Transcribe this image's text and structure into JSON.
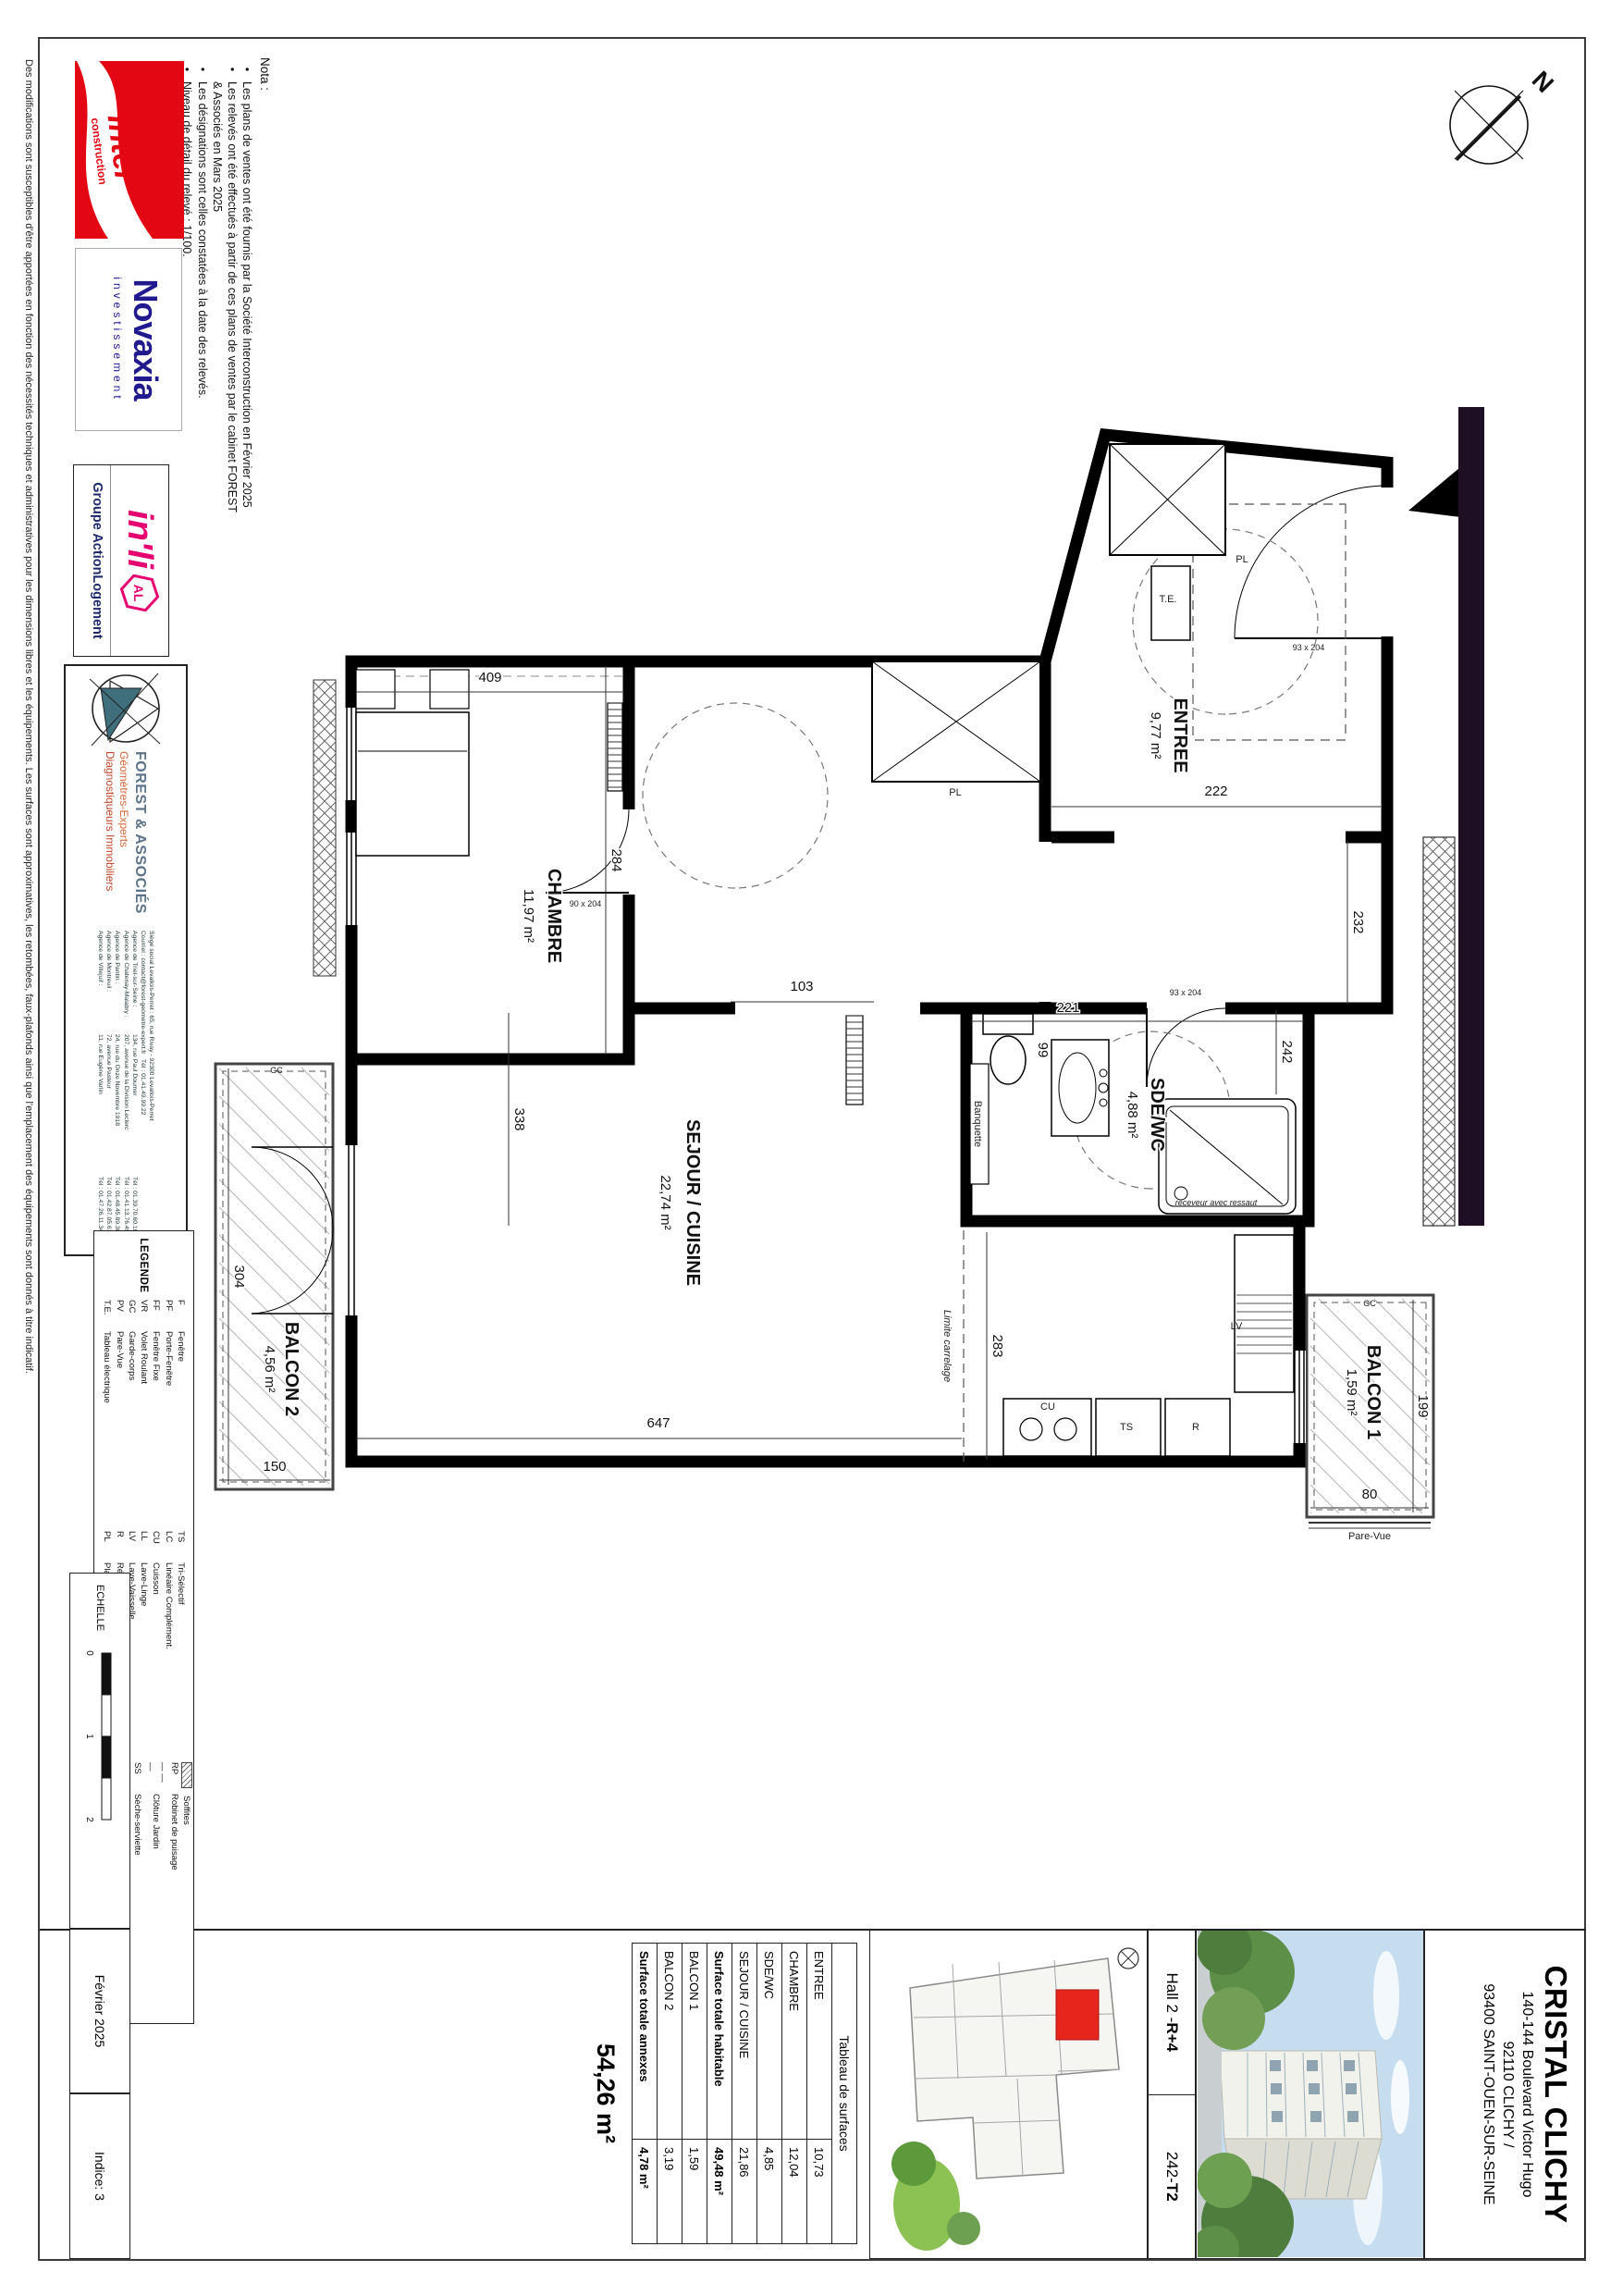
{
  "page": {
    "disclaimer": "Des modifications sont susceptibles d'être apportées en fonction des nécessités techniques et administratives pour les dimensions libres et les équipements. Les surfaces sont approximatives, les retombées, faux-plafonds ainsi que l'emplacement des équipements sont donnés à titre indicatif."
  },
  "nota": {
    "title": "Nota :",
    "lines": [
      {
        "bullet": "•",
        "text": "Les plans de ventes ont été fournis par la Société Interconstruction en Février 2025"
      },
      {
        "bullet": "•",
        "text": "Les relevés ont été effectués à partir de ces plans de ventes par le cabinet FOREST"
      },
      {
        "bullet": "",
        "text": "& Associés en Mars 2025"
      },
      {
        "bullet": "•",
        "text": "Les désignations sont celles constatées à la date des relevés."
      },
      {
        "bullet": "•",
        "text": "Niveau de détail du relevé : 1/100."
      }
    ]
  },
  "logos": {
    "inter_line1": "Inter",
    "inter_line2": "construction",
    "novaxia": "Novaxia",
    "novaxia_sub": "investissement",
    "inli": "in'li",
    "inli_badge": "AL",
    "inli_sub": "Groupe ActionLogement"
  },
  "forest": {
    "name": "FOREST & ASSOCIÉS",
    "sub1": "Géomètres-Experts",
    "sub2": "Diagnostiqueurs Immobiliers",
    "siege1": "Siège social Levallois-Perret : 65, rue Rivay - 92300 Levallois-Perret",
    "siege2": "Courriel : contact@forest-geometre-expert.fr",
    "siege3": "Tél : 01.41.49.99.22",
    "agences": [
      {
        "n": "Agence de Triel-sur-Seine :",
        "a": "134, rue Paul Doumer",
        "t": "Tél : 01.39.70.60.10"
      },
      {
        "n": "Agence de Chatenay-Malabry :",
        "a": "207, avenue de la Division Leclerc",
        "t": "Tél : 01.41.13.76.49"
      },
      {
        "n": "Agence de Pantin :",
        "a": "24, rue du Onze Novembre 1918",
        "t": "Tél : 01.48.45.89.30"
      },
      {
        "n": "Agence de Montreuil :",
        "a": "72, avenue Pasteur",
        "t": "Tél : 01.42.87.05.61"
      },
      {
        "n": "Agence de Villejuif :",
        "a": "11, rue Eugène Varlin",
        "t": "Tél : 01.47.26.11.34"
      }
    ]
  },
  "legend": {
    "title": "LEGENDE",
    "col1": [
      {
        "k": "F",
        "v": "Fenêtre"
      },
      {
        "k": "PF",
        "v": "Porte-Fenêtre"
      },
      {
        "k": "FF",
        "v": "Fenêtre Fixe"
      },
      {
        "k": "VR",
        "v": "Volet Roulant"
      },
      {
        "k": "GC",
        "v": "Garde-corps"
      },
      {
        "k": "PV",
        "v": "Pare-Vue"
      },
      {
        "k": "T.E.",
        "v": "Tableau électrique"
      }
    ],
    "col2": [
      {
        "k": "TS",
        "v": "Tri-Sélectif"
      },
      {
        "k": "LC",
        "v": "Linéaire Complément."
      },
      {
        "k": "CU",
        "v": "Cuisson"
      },
      {
        "k": "LL",
        "v": "Lave-Linge"
      },
      {
        "k": "LV",
        "v": "Lave-Vaisselle"
      },
      {
        "k": "R",
        "v": "Réfrigérateur"
      },
      {
        "k": "PL",
        "v": "Placard"
      }
    ],
    "col3": [
      {
        "k": "",
        "v": "Soffites"
      },
      {
        "k": "RP",
        "v": "Robinet de puisage"
      },
      {
        "k": "— — —",
        "v": "Clôture Jardin"
      },
      {
        "k": "SS",
        "v": "Sèche-serviette"
      },
      {
        "k": "TV",
        "v": "Trappe de visite"
      },
      {
        "k": "",
        "v": "Radiateur"
      },
      {
        "k": "HSS",
        "v": "Hauteur sous soffite"
      }
    ]
  },
  "surfaces_table": {
    "title": "Tableau de surfaces",
    "rows": [
      {
        "label": "ENTREE",
        "value": "10,73"
      },
      {
        "label": "CHAMBRE",
        "value": "12,04"
      },
      {
        "label": "SDE/WC",
        "value": "4,85"
      },
      {
        "label": "SEJOUR / CUISINE",
        "value": "21,86"
      }
    ],
    "total_habitable_label": "Surface totale habitable",
    "total_habitable_value": "49,48 m²",
    "annex_rows": [
      {
        "label": "BALCON 1",
        "value": "1,59"
      },
      {
        "label": "BALCON 2",
        "value": "3,19"
      }
    ],
    "total_annexes_label": "Surface totale annexes",
    "total_annexes_value": "4,78 m²",
    "grand_total": "54,26 m²"
  },
  "title_block": {
    "project": "CRISTAL CLICHY",
    "address1": "140-144 Boulevard Victor Hugo",
    "address2": "92110 CLICHY /",
    "address3": "93400 SAINT-OUEN-SUR-SEINE",
    "hall_prefix": "Hall 2 - ",
    "hall_bold": "R+4",
    "lot_prefix": "242-",
    "lot_bold": "T2"
  },
  "footer": {
    "echelle": "ECHELLE",
    "tick0": "0",
    "tick1": "1",
    "tick2": "2",
    "date": "Février 2025",
    "indice": "Indice: 3"
  },
  "plan": {
    "north": "N",
    "rooms": {
      "entree": {
        "name": "ENTREE",
        "area": "9,77 m²"
      },
      "chambre": {
        "name": "CHAMBRE",
        "area": "11,97 m²"
      },
      "sde": {
        "name": "SDE/WC",
        "area": "4,88 m²"
      },
      "sejour": {
        "name": "SEJOUR / CUISINE",
        "area": "22,74 m²"
      },
      "balcon1": {
        "name": "BALCON 1",
        "area": "1,59 m²"
      },
      "balcon2": {
        "name": "BALCON 2",
        "area": "4,56 m²"
      }
    },
    "dims": {
      "d222": "222",
      "d232": "232",
      "d242": "242",
      "d221": "221",
      "d103": "103",
      "d409": "409",
      "d284": "284",
      "d647": "647",
      "d338": "338",
      "d283": "283",
      "d304": "304",
      "d150": "150",
      "d199": "199",
      "d80": "80",
      "d99": "99"
    },
    "labels": {
      "te": "T.E.",
      "pl": "PL",
      "pl2": "PL",
      "lv": "LV",
      "cu": "CU",
      "ts": "TS",
      "r": "R",
      "gc1": "GC",
      "gc2": "GC",
      "banquette": "Banquette",
      "receveur": "receveur avec ressaut",
      "limite": "Limite carrelage",
      "pare_vue": "Pare-Vue",
      "door1": "93 x 204",
      "door2": "93 x 204",
      "door3": "90 x 204"
    }
  }
}
